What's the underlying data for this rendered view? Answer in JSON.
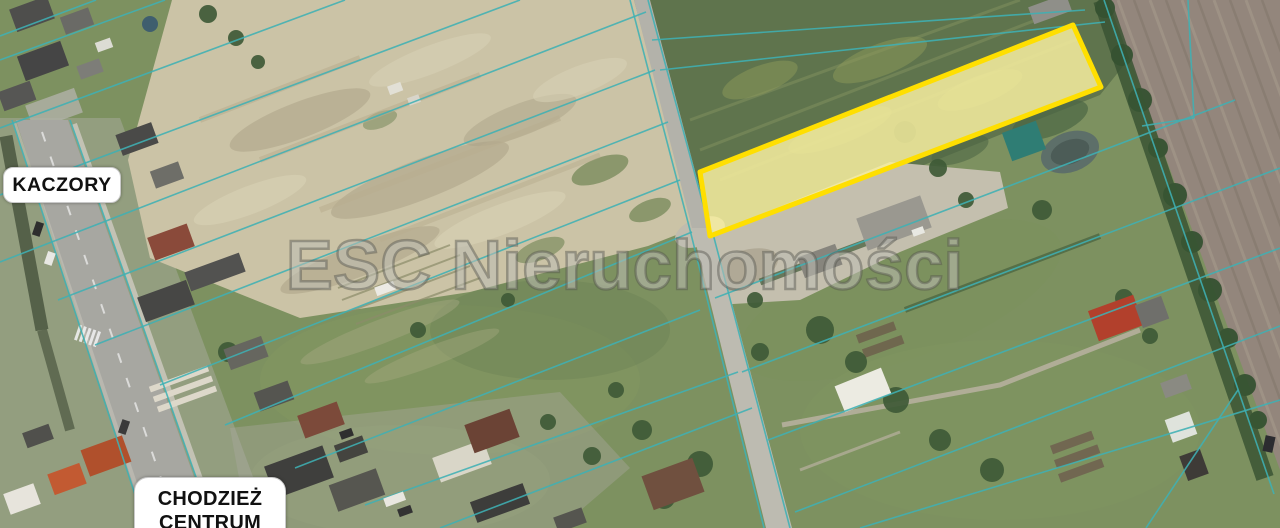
{
  "map": {
    "description": "aerial cadastral map with highlighted building plot",
    "watermark": "ESC Nieruchomości",
    "labels": [
      {
        "id": "kaczory",
        "text": "KACZORY"
      },
      {
        "id": "chodziez-centrum",
        "line1": "CHODZIEŻ",
        "line2": "CENTRUM"
      }
    ],
    "highlighted_parcel": {
      "status": "highlighted offer plot"
    }
  },
  "colors": {
    "parcel_outline": "#ffdf00",
    "parcel_fill": "#f7eea0",
    "cadastral_line": "#3fb0b4",
    "label_bg": "#ffffff",
    "label_text": "#111111",
    "watermark_fill": "rgba(190,190,180,0.55)"
  }
}
